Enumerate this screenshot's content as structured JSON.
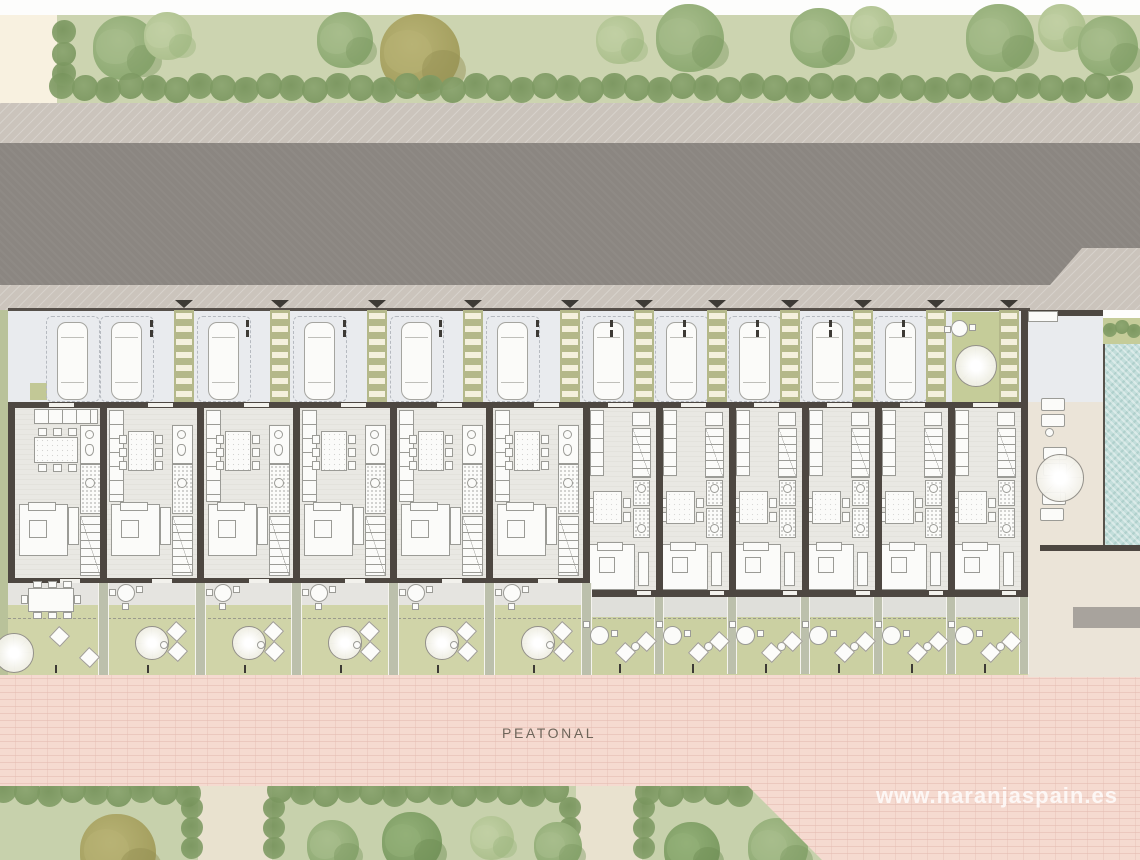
{
  "labels": {
    "walkway": "PEATONAL",
    "watermark": "www.naranjaspain.es"
  },
  "colors": {
    "white_top": "#fdfdfc",
    "cream": "#f8f1e0",
    "garden": "#ccd4b0",
    "hedge1": "#87a26c",
    "hedge2": "#75925a",
    "sidewalk": "#cbc4bc",
    "road": "#8b8681",
    "parking": "#e9ebee",
    "walkway": "#b4b88a",
    "walkway_bar": "#f4f0dd",
    "wall": "#4d4741",
    "wall_light": "#f2f1ec",
    "floor": "#e9e8e3",
    "fur_fill": "#fbfbf9",
    "fur_line": "#9b9b96",
    "terrace_a": "#e5e4e0",
    "terrace_b": "#dfdfda",
    "lawn": "#d0d4a8",
    "lawn_b": "#cbd0a2",
    "patio": "#c5cc99",
    "fence": "#bcc0ac",
    "fence_edge": "#f5f4ef",
    "pink": "#f5dad0",
    "pink_line": "#e3bab0",
    "pool": "#c3dedb",
    "pool_edge": "#57524b",
    "beige": "#ebe4d8",
    "gray_block": "#a8a39d",
    "bottom_lawn": "#c7d1ac",
    "path": "#e9e2cf",
    "label": "#6e655a",
    "dash": "#9a9a8e",
    "tick": "#3d3a35",
    "car_line": "#a5a5a0",
    "left_strip": "#b9c29a",
    "planter": "#c2c896",
    "bush_small": "#8ea873"
  },
  "tree_palettes": {
    "green": [
      "#8fab74",
      "#a8bd8c",
      "#7c9a62"
    ],
    "light": [
      "#aec18f",
      "#c1d0a4",
      "#9cb57e"
    ],
    "olive": [
      "#a49f5f",
      "#b8b375",
      "#938e51"
    ],
    "dark": [
      "#7d9c63",
      "#93b078",
      "#6c8b53"
    ]
  },
  "plan": {
    "canvas": {
      "w": 1140,
      "h": 860
    },
    "top_garden": {
      "trees": [
        [
          125,
          48,
          32,
          "green"
        ],
        [
          168,
          36,
          24,
          "light"
        ],
        [
          345,
          40,
          28,
          "green"
        ],
        [
          420,
          54,
          40,
          "olive"
        ],
        [
          620,
          40,
          24,
          "light"
        ],
        [
          690,
          38,
          34,
          "green"
        ],
        [
          820,
          38,
          30,
          "green"
        ],
        [
          872,
          28,
          22,
          "light"
        ],
        [
          1000,
          38,
          34,
          "green"
        ],
        [
          1062,
          28,
          24,
          "light"
        ],
        [
          1108,
          46,
          30,
          "green"
        ]
      ],
      "hedge": {
        "x0": 62,
        "x1": 1136,
        "step": 23,
        "y": 88
      },
      "left_column": [
        [
          64,
          32
        ],
        [
          64,
          54
        ],
        [
          64,
          74
        ]
      ]
    },
    "parking": {
      "walkways": [
        174,
        270,
        367,
        463,
        560,
        634,
        707,
        780,
        853,
        926,
        999
      ],
      "cars": [
        57,
        111,
        208,
        304,
        401,
        497,
        593,
        666,
        739,
        812,
        885
      ],
      "corner_car": {
        "x": 1050,
        "y": 324,
        "w": 31,
        "h": 78
      },
      "patio": {
        "x": 952,
        "y": 312,
        "w": 47,
        "h": 90
      },
      "planter": {
        "x": 30,
        "y": 383,
        "w": 17,
        "h": 17
      }
    },
    "houses": {
      "units_a": [
        8,
        100,
        197,
        293,
        390,
        486
      ],
      "a_end": 583,
      "units_b": [
        583,
        656,
        729,
        802,
        875,
        948
      ],
      "b_end": 1021,
      "top_wall_gaps": [
        49,
        148,
        244,
        341,
        437,
        534,
        608,
        681,
        754,
        827,
        900,
        973
      ]
    },
    "gardens": {
      "fences_a": [
        100,
        197,
        293,
        390,
        486,
        583
      ],
      "fences_b": [
        656,
        729,
        802,
        875,
        948,
        1021
      ]
    },
    "courtyard": {
      "loungers": [
        [
          1041,
          398
        ],
        [
          1041,
          414
        ],
        [
          1043,
          447
        ],
        [
          1043,
          463
        ],
        [
          1042,
          492
        ],
        [
          1040,
          508
        ]
      ],
      "side_table": [
        1049,
        432,
        4
      ],
      "parasol": [
        1060,
        478,
        24
      ],
      "storage": [
        1028,
        311,
        30,
        11
      ],
      "gray_block": [
        1073,
        607,
        67,
        21
      ],
      "pool": {
        "x": 1103,
        "y": 344,
        "w": 37,
        "h": 201
      },
      "planter": {
        "x": 1103,
        "y": 318,
        "w": 37,
        "h": 26
      },
      "planter_bushes": [
        [
          1110,
          330
        ],
        [
          1122,
          327
        ],
        [
          1134,
          331
        ]
      ]
    },
    "bottom": {
      "trees": [
        [
          118,
          852,
          38,
          "olive"
        ],
        [
          333,
          846,
          26,
          "green"
        ],
        [
          412,
          842,
          30,
          "dark"
        ],
        [
          492,
          838,
          22,
          "light"
        ],
        [
          558,
          846,
          24,
          "green"
        ],
        [
          692,
          850,
          28,
          "dark"
        ],
        [
          778,
          848,
          30,
          "green"
        ]
      ],
      "paths": [
        [
          198,
          74
        ],
        [
          576,
          66
        ]
      ],
      "hedge": {
        "x0": 4,
        "x1": 746,
        "step": 23,
        "gaps": [
          [
            190,
            278
          ],
          [
            568,
            648
          ]
        ]
      }
    }
  }
}
